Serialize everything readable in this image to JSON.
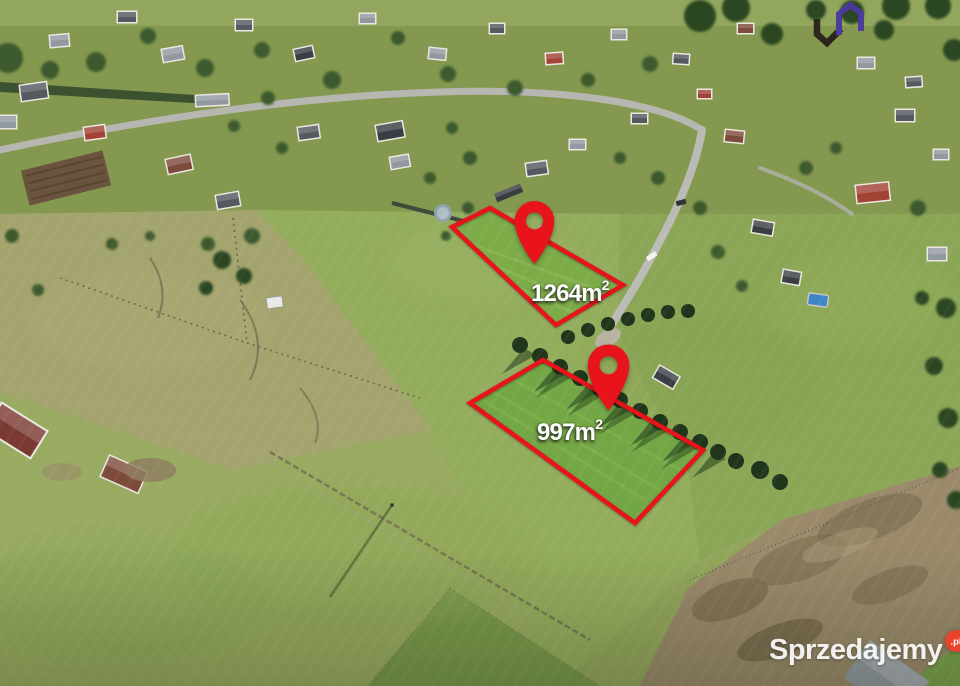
{
  "photo": {
    "plot_labels": [
      {
        "area": "1264m",
        "sup": "2"
      },
      {
        "area": "997m",
        "sup": "2"
      }
    ],
    "accent_red": "#e8131b"
  },
  "branding": {
    "logo_colors": {
      "dark": "#2a221d",
      "purple": "#4a3a9d"
    },
    "watermark": {
      "text": "Sprzedajemy",
      "tld": ".pl",
      "badge_color": "#e8432d"
    }
  }
}
